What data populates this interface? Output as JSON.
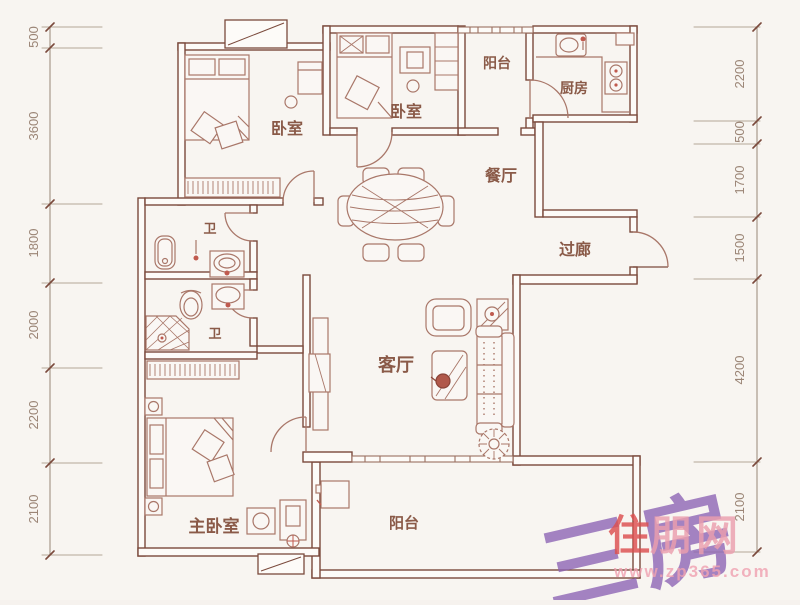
{
  "plan": {
    "type": "floor-plan",
    "rooms": [
      {
        "id": "bedroom-1",
        "label": "卧室"
      },
      {
        "id": "bedroom-2",
        "label": "卧室"
      },
      {
        "id": "balcony-top",
        "label": "阳台"
      },
      {
        "id": "kitchen",
        "label": "厨房"
      },
      {
        "id": "dining-room",
        "label": "餐厅"
      },
      {
        "id": "corridor",
        "label": "过廊"
      },
      {
        "id": "bathroom-1",
        "label": "卫"
      },
      {
        "id": "bathroom-2",
        "label": "卫"
      },
      {
        "id": "living-room",
        "label": "客厅"
      },
      {
        "id": "master-bedroom",
        "label": "主卧室"
      },
      {
        "id": "balcony-bottom",
        "label": "阳台"
      }
    ]
  },
  "dimensions": {
    "left": [
      "500",
      "3600",
      "1800",
      "2000",
      "2200",
      "2100"
    ],
    "right": [
      "2200",
      "500",
      "1700",
      "1500",
      "4200",
      "2100"
    ]
  },
  "watermark": {
    "plan_type": "三房",
    "logo_first_char": "住",
    "logo_rest": "朋网",
    "site_url": "www.zp365.com"
  },
  "palette": {
    "wall": "#7b4a3c",
    "furniture": "#a97769",
    "label": "#8a5a48",
    "dimension": "#9b8576",
    "accent_red": "#c05a4e",
    "watermark_purple": "#8c63b4",
    "logo_red": "#dd4f4f",
    "logo_pink": "#eb9fae",
    "background": "#f8f5f1"
  }
}
